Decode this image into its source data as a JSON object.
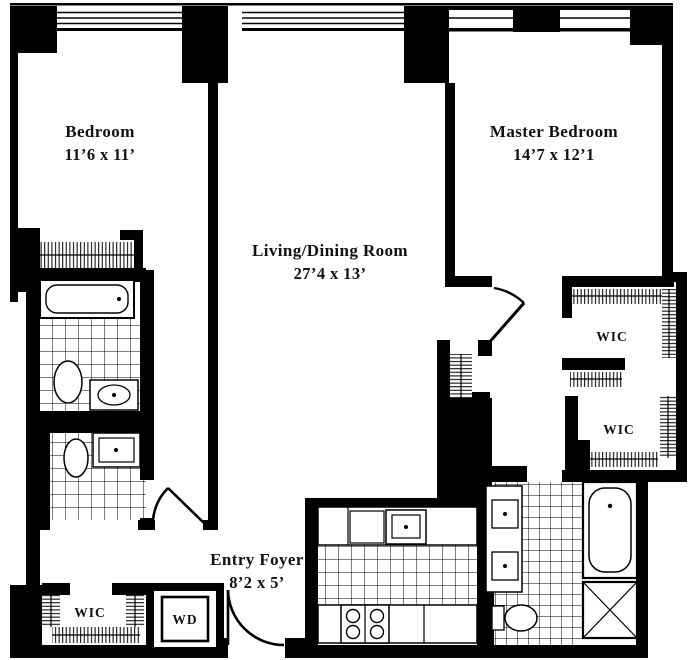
{
  "plan": {
    "type": "apartment-floor-plan",
    "wall_color": "#000000",
    "floor_color": "#ffffff",
    "rooms": {
      "bedroom": {
        "name": "Bedroom",
        "dims": "11’6 x 11’"
      },
      "living": {
        "name": "Living/Dining Room",
        "dims": "27’4 x 13’"
      },
      "master": {
        "name": "Master Bedroom",
        "dims": "14’7 x 12’1"
      },
      "foyer": {
        "name": "Entry Foyer",
        "dims": "8’2 x 5’"
      },
      "wic_master_upper": {
        "label": "WIC"
      },
      "wic_master_lower": {
        "label": "WIC"
      },
      "wic_hall": {
        "label": "WIC"
      },
      "laundry": {
        "label": "WD"
      }
    }
  }
}
